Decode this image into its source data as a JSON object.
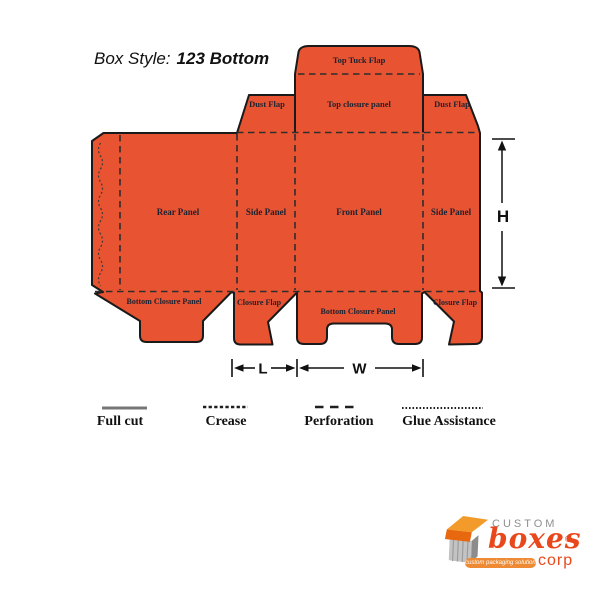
{
  "title": {
    "prefix": "Box Style:",
    "name": "123 Bottom"
  },
  "dieline": {
    "top_tuck_flap": "Top Tuck Flap",
    "dust_flap_left": "Dust Flap",
    "top_closure_panel": "Top closure panel",
    "dust_flap_right": "Dust Flap",
    "rear_panel": "Rear Panel",
    "side_panel_left": "Side Panel",
    "front_panel": "Front Panel",
    "side_panel_right": "Side Panel",
    "bottom_closure_rear": "Bottom Closure Panel",
    "closure_flap_left": "Closure Flap",
    "bottom_closure_front": "Bottom Closure Panel",
    "closure_flap_right": "Closure Flap"
  },
  "dimensions": {
    "height": "H",
    "length": "L",
    "width": "W"
  },
  "legend": {
    "items": [
      {
        "label": "Full cut",
        "style": "solid"
      },
      {
        "label": "Crease",
        "style": "dotted"
      },
      {
        "label": "Perforation",
        "style": "dashed"
      },
      {
        "label": "Glue Assistance",
        "style": "fine-dotted"
      }
    ]
  },
  "colors": {
    "panel_fill": "#E85331",
    "cut_line": "#1a1a1a",
    "crease_line": "#2e2e2e",
    "label_text": "#1d2230",
    "logo_orange": "#E8481B",
    "logo_gray": "#8f8f8f"
  },
  "logo": {
    "brand_top": "custom",
    "brand_main": "boxes",
    "brand_suffix": "corp",
    "registered_mark": "®",
    "tagline": "custom packaging solutions"
  }
}
